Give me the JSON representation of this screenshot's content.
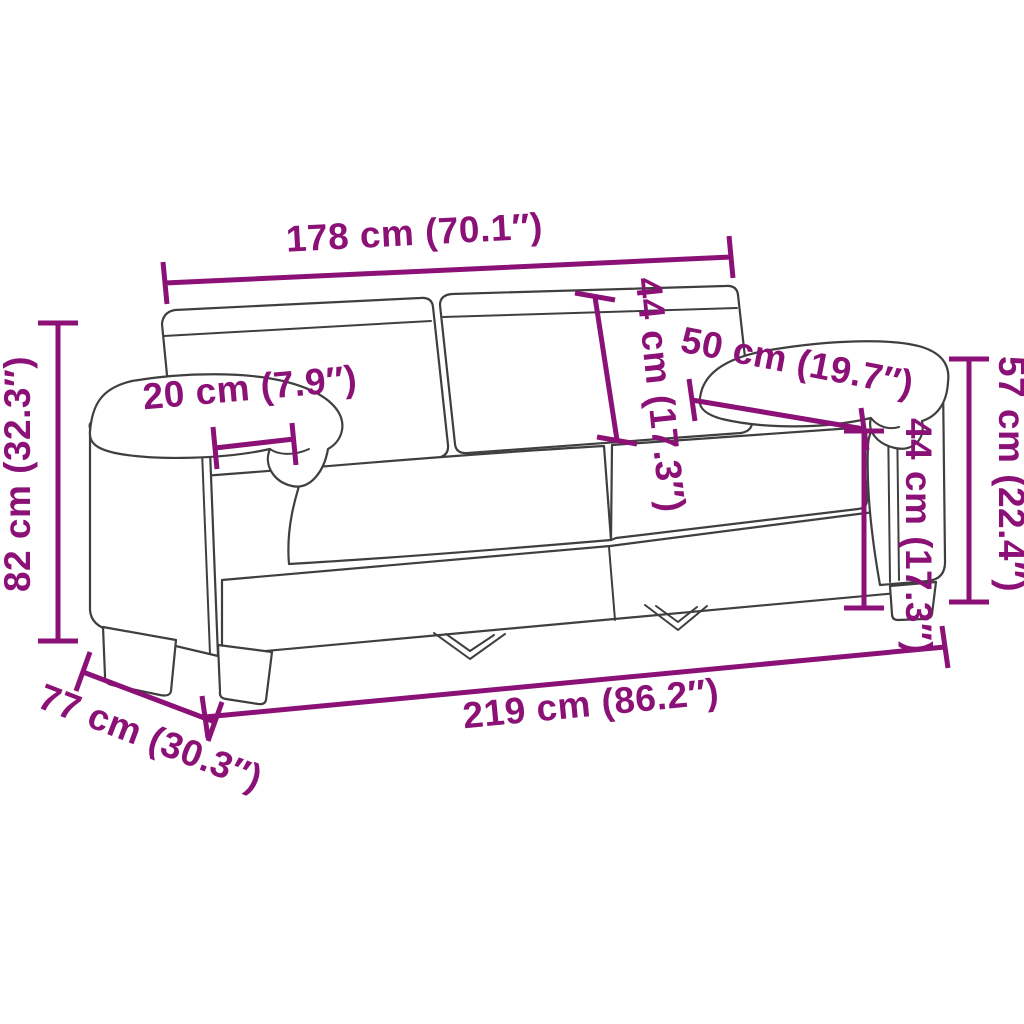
{
  "colors": {
    "accent": "#8B1176",
    "line": "#3F3F3F",
    "background": "#FFFFFF"
  },
  "diagram": {
    "subject": "two-seater-sofa-dimension-line-drawing",
    "dimensions": {
      "width_between_arms": {
        "label": "178 cm (70.1″)"
      },
      "backrest_height": {
        "label": "44 cm (17.3″)"
      },
      "armrest_depth": {
        "label": "50 cm (19.7″)"
      },
      "seat_height": {
        "label": "44 cm (17.3″)"
      },
      "armrest_height": {
        "label": "57 cm (22.4″)"
      },
      "armrest_width": {
        "label": "20 cm (7.9″)"
      },
      "total_height": {
        "label": "82 cm (32.3″)"
      },
      "total_width": {
        "label": "219 cm (86.2″)"
      },
      "total_depth": {
        "label": "77 cm (30.3″)"
      }
    }
  }
}
